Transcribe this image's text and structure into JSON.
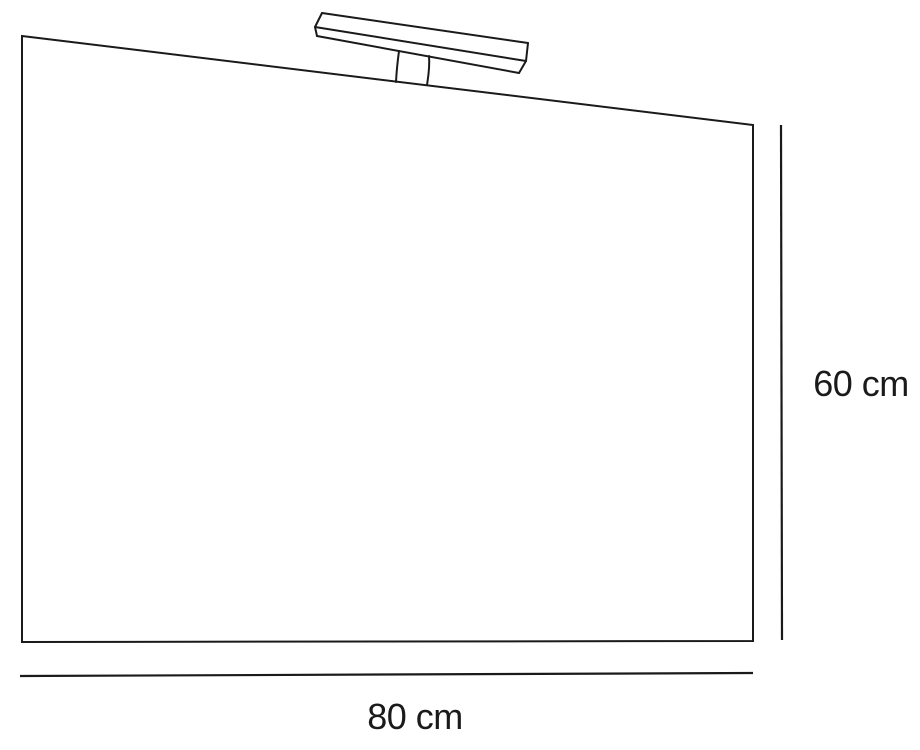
{
  "diagram": {
    "type": "product-dimension-drawing",
    "subject": "bathroom-mirror-with-top-lamp",
    "labels": {
      "height": "60 cm",
      "width": "80 cm"
    },
    "dimensions": {
      "width_cm": 80,
      "height_cm": 60
    },
    "colors": {
      "line": "#1a1a1a",
      "background": "#ffffff",
      "text": "#1a1a1a"
    }
  }
}
